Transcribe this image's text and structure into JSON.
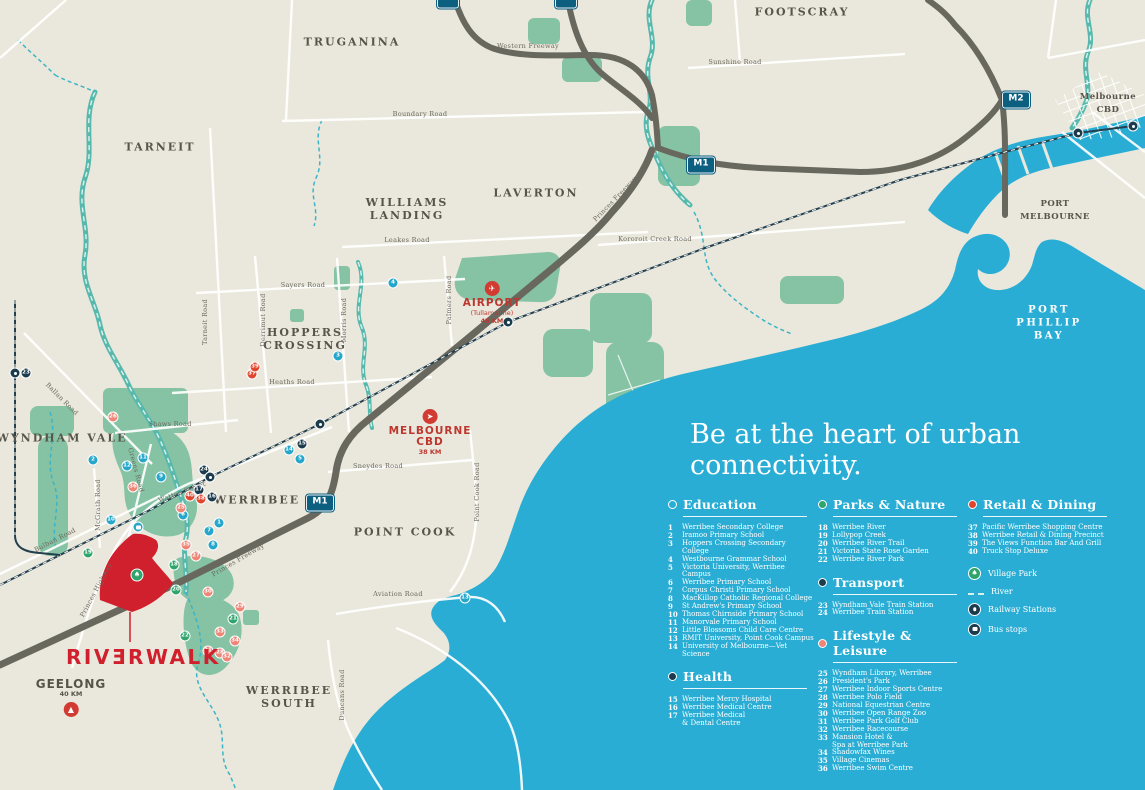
{
  "headline": "Be at the heart of urban connectivity.",
  "logo": {
    "text": "RIVƎRWALK"
  },
  "colors": {
    "water": "#2aadd4",
    "land": "#eae8dc",
    "park": "#85c3a4",
    "accent_red": "#d0202d",
    "education": "#25a7cb",
    "parks": "#2fa56c",
    "transport": "#1c3c4e",
    "health": "#1c3c4e",
    "lifestyle": "#ee8678",
    "retail": "#e0462e",
    "shield_blue": "#0d5f80"
  },
  "legend": {
    "sections": [
      {
        "id": "education",
        "col": 0,
        "title": "Education",
        "color": "education",
        "bullet": "outline",
        "items": [
          {
            "n": "1",
            "label": "Werribee Secondary College"
          },
          {
            "n": "2",
            "label": "Iramoo Primary School"
          },
          {
            "n": "3",
            "label": "Hoppers Crossing Secondary College"
          },
          {
            "n": "4",
            "label": "Westbourne Grammar School"
          },
          {
            "n": "5",
            "label": "Victoria University, Werribee Campus"
          },
          {
            "n": "6",
            "label": "Werribee Primary School"
          },
          {
            "n": "7",
            "label": "Corpus Christi Primary School"
          },
          {
            "n": "8",
            "label": "MacKillop Catholic Regional College"
          },
          {
            "n": "9",
            "label": "St Andrew's Primary School"
          },
          {
            "n": "10",
            "label": "Thomas Chirnside Primary School"
          },
          {
            "n": "11",
            "label": "Manorvale Primary School"
          },
          {
            "n": "12",
            "label": "Little Blossoms Child Care Centre"
          },
          {
            "n": "13",
            "label": "RMIT University, Point Cook Campus"
          },
          {
            "n": "14",
            "label": "University of Melbourne—Vet Science"
          }
        ]
      },
      {
        "id": "health",
        "col": 0,
        "title": "Health",
        "color": "health",
        "bullet": "fill",
        "items": [
          {
            "n": "15",
            "label": "Werribee Mercy Hospital"
          },
          {
            "n": "16",
            "label": "Werribee Medical Centre"
          },
          {
            "n": "17",
            "label": "Werribee Medical\n& Dental Centre"
          }
        ]
      },
      {
        "id": "parks",
        "col": 1,
        "title": "Parks & Nature",
        "color": "parks",
        "bullet": "fill",
        "items": [
          {
            "n": "18",
            "label": "Werribee River"
          },
          {
            "n": "19",
            "label": "Lollypop Creek"
          },
          {
            "n": "20",
            "label": "Werribee River Trail"
          },
          {
            "n": "21",
            "label": "Victoria State Rose Garden"
          },
          {
            "n": "22",
            "label": "Werribee River Park"
          }
        ]
      },
      {
        "id": "transport",
        "col": 1,
        "title": "Transport",
        "color": "transport",
        "bullet": "fill",
        "items": [
          {
            "n": "23",
            "label": "Wyndham Vale Train Station"
          },
          {
            "n": "24",
            "label": "Werribee Train Station"
          }
        ]
      },
      {
        "id": "lifestyle",
        "col": 1,
        "title": "Lifestyle & Leisure",
        "color": "lifestyle",
        "bullet": "fill",
        "items": [
          {
            "n": "25",
            "label": "Wyndham Library, Werribee"
          },
          {
            "n": "26",
            "label": "President's Park"
          },
          {
            "n": "27",
            "label": "Werribee Indoor Sports Centre"
          },
          {
            "n": "28",
            "label": "Werribee Polo Field"
          },
          {
            "n": "29",
            "label": "National Equestrian Centre"
          },
          {
            "n": "30",
            "label": "Werribee Open Range Zoo"
          },
          {
            "n": "31",
            "label": "Werribee Park Golf Club"
          },
          {
            "n": "32",
            "label": "Werribee Racecourse"
          },
          {
            "n": "33",
            "label": "Mansion Hotel &\nSpa at Werribee Park"
          },
          {
            "n": "34",
            "label": "Shadowfax Wines"
          },
          {
            "n": "35",
            "label": "Village Cinemas"
          },
          {
            "n": "36",
            "label": "Werribee Swim Centre"
          }
        ]
      },
      {
        "id": "retail",
        "col": 2,
        "title": "Retail & Dining",
        "color": "retail",
        "bullet": "fill",
        "items": [
          {
            "n": "37",
            "label": "Pacific Werribee Shopping Centre"
          },
          {
            "n": "38",
            "label": "Werribee Retail & Dining Precinct"
          },
          {
            "n": "39",
            "label": "The Views Function Bar And Grill"
          },
          {
            "n": "40",
            "label": "Truck Stop Deluxe"
          }
        ]
      }
    ],
    "symbols": [
      {
        "id": "village-park",
        "label": "Village Park"
      },
      {
        "id": "river",
        "label": "River"
      },
      {
        "id": "railway",
        "label": "Railway Stations"
      },
      {
        "id": "bus",
        "label": "Bus stops"
      }
    ]
  },
  "map": {
    "areas": [
      {
        "text": "TRUGANINA",
        "x": 352,
        "y": 42
      },
      {
        "text": "TARNEIT",
        "x": 160,
        "y": 147
      },
      {
        "text": "WILLIAMS\nLANDING",
        "x": 407,
        "y": 209
      },
      {
        "text": "LAVERTON",
        "x": 536,
        "y": 193
      },
      {
        "text": "FOOTSCRAY",
        "x": 802,
        "y": 12
      },
      {
        "text": "HOPPERS\nCROSSING",
        "x": 305,
        "y": 339
      },
      {
        "text": "WYNDHAM VALE",
        "x": 62,
        "y": 438
      },
      {
        "text": "WERRIBEE",
        "x": 257,
        "y": 500
      },
      {
        "text": "POINT COOK",
        "x": 405,
        "y": 532
      },
      {
        "text": "WERRIBEE\nSOUTH",
        "x": 289,
        "y": 697
      },
      {
        "text": "PORT MELBOURNE",
        "x": 1055,
        "y": 211,
        "variant": "small"
      },
      {
        "text": "PORT PHILLIP BAY",
        "x": 1049,
        "y": 323,
        "variant": "water"
      },
      {
        "text": "Melbourne CBD",
        "x": 1108,
        "y": 104,
        "variant": "small"
      }
    ],
    "roads": [
      {
        "text": "Western Freeway",
        "x": 528,
        "y": 46,
        "angle": 0
      },
      {
        "text": "Sunshine Road",
        "x": 735,
        "y": 62,
        "angle": 0
      },
      {
        "text": "Boundary Road",
        "x": 420,
        "y": 114,
        "angle": 0
      },
      {
        "text": "Leakes Road",
        "x": 407,
        "y": 240,
        "angle": 0
      },
      {
        "text": "Kororoit Creek Road",
        "x": 655,
        "y": 239,
        "angle": 0
      },
      {
        "text": "Princes Freeway",
        "x": 615,
        "y": 199,
        "angle": -46
      },
      {
        "text": "Princes Freeway",
        "x": 238,
        "y": 560,
        "angle": -30
      },
      {
        "text": "Sayers Road",
        "x": 303,
        "y": 285,
        "angle": 0
      },
      {
        "text": "Tarneit Road",
        "x": 205,
        "y": 322,
        "angle": -90
      },
      {
        "text": "Derrimut Road",
        "x": 263,
        "y": 320,
        "angle": -90
      },
      {
        "text": "Morris Road",
        "x": 344,
        "y": 320,
        "angle": -90
      },
      {
        "text": "Palmers Road",
        "x": 449,
        "y": 300,
        "angle": -90
      },
      {
        "text": "Heaths Road",
        "x": 292,
        "y": 382,
        "angle": 0
      },
      {
        "text": "Shaws Road",
        "x": 170,
        "y": 424,
        "angle": 0
      },
      {
        "text": "Greens Road",
        "x": 136,
        "y": 470,
        "angle": 75
      },
      {
        "text": "Ballan Road",
        "x": 62,
        "y": 399,
        "angle": 45
      },
      {
        "text": "Bulban Road",
        "x": 55,
        "y": 540,
        "angle": -27
      },
      {
        "text": "McGrath Road",
        "x": 98,
        "y": 505,
        "angle": -90
      },
      {
        "text": "Princes Highway",
        "x": 96,
        "y": 590,
        "angle": -62
      },
      {
        "text": "Watton Street",
        "x": 182,
        "y": 492,
        "angle": -20
      },
      {
        "text": "Sneydes Road",
        "x": 378,
        "y": 466,
        "angle": 0
      },
      {
        "text": "Point Cook Road",
        "x": 477,
        "y": 492,
        "angle": -90
      },
      {
        "text": "Aviation Road",
        "x": 398,
        "y": 594,
        "angle": 0
      },
      {
        "text": "Duncans Road",
        "x": 342,
        "y": 695,
        "angle": -90
      }
    ],
    "shields": [
      {
        "text": "M1",
        "x": 320,
        "y": 503
      },
      {
        "text": "M1",
        "x": 701,
        "y": 165
      },
      {
        "text": "M2",
        "x": 1016,
        "y": 100
      },
      {
        "text": "",
        "x": 448,
        "y": 0,
        "cut": true
      },
      {
        "text": "",
        "x": 566,
        "y": 0,
        "cut": true
      }
    ],
    "destinations": [
      {
        "id": "airport",
        "icon": "✈",
        "name": "AIRPORT",
        "sub": "(Tullamarine)",
        "dist": "45 KM",
        "x": 492,
        "y": 281
      },
      {
        "id": "melbourne-cbd",
        "icon": "➤",
        "name": "MELBOURNE\nCBD",
        "sub": "",
        "dist": "38 KM",
        "x": 430,
        "y": 409
      },
      {
        "id": "geelong",
        "icon": "▲",
        "name": "GEELONG",
        "sub": "",
        "dist": "40 KM",
        "x": 71,
        "y": 679,
        "variant": "gray"
      }
    ],
    "markers": [
      {
        "n": "1",
        "c": "education",
        "x": 219,
        "y": 523
      },
      {
        "n": "2",
        "c": "education",
        "x": 93,
        "y": 460
      },
      {
        "n": "3",
        "c": "education",
        "x": 338,
        "y": 356
      },
      {
        "n": "4",
        "c": "education",
        "x": 393,
        "y": 283
      },
      {
        "n": "5",
        "c": "education",
        "x": 300,
        "y": 459
      },
      {
        "n": "6",
        "c": "education",
        "x": 183,
        "y": 515
      },
      {
        "n": "7",
        "c": "education",
        "x": 209,
        "y": 531
      },
      {
        "n": "8",
        "c": "education",
        "x": 213,
        "y": 545
      },
      {
        "n": "9",
        "c": "education",
        "x": 161,
        "y": 477
      },
      {
        "n": "10",
        "c": "education",
        "x": 111,
        "y": 520
      },
      {
        "n": "11",
        "c": "education",
        "x": 143,
        "y": 458
      },
      {
        "n": "12",
        "c": "education",
        "x": 127,
        "y": 466
      },
      {
        "n": "13",
        "c": "education",
        "x": 465,
        "y": 598
      },
      {
        "n": "14",
        "c": "education",
        "x": 289,
        "y": 450
      },
      {
        "n": "15",
        "c": "health",
        "x": 302,
        "y": 444
      },
      {
        "n": "16",
        "c": "health",
        "x": 212,
        "y": 497
      },
      {
        "n": "17",
        "c": "health",
        "x": 199,
        "y": 490
      },
      {
        "n": "18",
        "c": "parks",
        "x": 174,
        "y": 565
      },
      {
        "n": "19",
        "c": "parks",
        "x": 88,
        "y": 553
      },
      {
        "n": "20",
        "c": "parks",
        "x": 176,
        "y": 590
      },
      {
        "n": "21",
        "c": "parks",
        "x": 233,
        "y": 619
      },
      {
        "n": "22",
        "c": "parks",
        "x": 185,
        "y": 636
      },
      {
        "n": "23",
        "c": "transport",
        "x": 26,
        "y": 373
      },
      {
        "n": "24",
        "c": "transport",
        "x": 204,
        "y": 470
      },
      {
        "n": "25",
        "c": "lifestyle",
        "x": 181,
        "y": 508
      },
      {
        "n": "26",
        "c": "lifestyle",
        "x": 113,
        "y": 417
      },
      {
        "n": "27",
        "c": "lifestyle",
        "x": 196,
        "y": 556
      },
      {
        "n": "28",
        "c": "lifestyle",
        "x": 220,
        "y": 653
      },
      {
        "n": "29",
        "c": "lifestyle",
        "x": 240,
        "y": 607
      },
      {
        "n": "30",
        "c": "lifestyle",
        "x": 208,
        "y": 592
      },
      {
        "n": "31",
        "c": "lifestyle",
        "x": 208,
        "y": 651
      },
      {
        "n": "32",
        "c": "lifestyle",
        "x": 227,
        "y": 657
      },
      {
        "n": "33",
        "c": "lifestyle",
        "x": 220,
        "y": 632
      },
      {
        "n": "34",
        "c": "lifestyle",
        "x": 235,
        "y": 641
      },
      {
        "n": "35",
        "c": "lifestyle",
        "x": 186,
        "y": 545
      },
      {
        "n": "36",
        "c": "lifestyle",
        "x": 133,
        "y": 487
      },
      {
        "n": "37",
        "c": "retail",
        "x": 252,
        "y": 374
      },
      {
        "n": "38",
        "c": "retail",
        "x": 201,
        "y": 499
      },
      {
        "n": "39",
        "c": "retail",
        "x": 255,
        "y": 367
      },
      {
        "n": "40",
        "c": "retail",
        "x": 190,
        "y": 496
      }
    ],
    "stations": [
      [
        15,
        373
      ],
      [
        210,
        477
      ],
      [
        320,
        424
      ],
      [
        508,
        322
      ],
      [
        1078,
        133
      ],
      [
        1133,
        126
      ]
    ],
    "bus_stops": [
      [
        138,
        527
      ]
    ],
    "village_parks": [
      [
        137,
        575
      ]
    ]
  }
}
